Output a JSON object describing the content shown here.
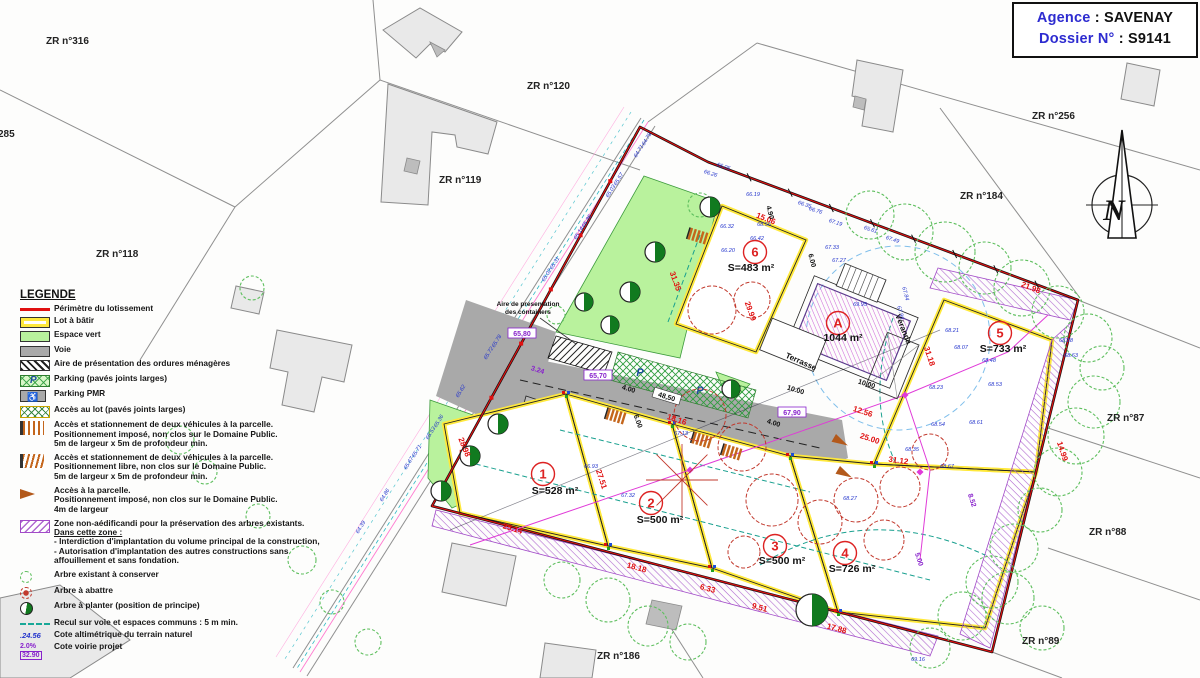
{
  "header": {
    "agency_label": "Agence",
    "agency_sep": " : ",
    "agency_value": "SAVENAY",
    "dossier_label": "Dossier N°",
    "dossier_sep": " : ",
    "dossier_value": "S9141"
  },
  "colors": {
    "perimeter_red": "#e01010",
    "lot_yellow": "#ffe93c",
    "green_space": "#b9f29d",
    "road_gray": "#a9a9a9",
    "hatch_purple": "#a24bc8",
    "elevation_blue": "#2233cc",
    "label_blue": "#2d2bd0",
    "tree_green": "#5fbf5f",
    "tree_red": "#c23a2e",
    "tree_plant_green": "#117a1f",
    "setback_teal": "#18a898"
  },
  "north": {
    "label": "N"
  },
  "legend": {
    "title": "LEGENDE",
    "items": [
      {
        "swatch": "perimeter",
        "lines": [
          "Périmètre du lotissement"
        ]
      },
      {
        "swatch": "lot",
        "lines": [
          "Lot à bâtir"
        ]
      },
      {
        "swatch": "green",
        "lines": [
          "Espace vert"
        ]
      },
      {
        "swatch": "road",
        "lines": [
          "Voie"
        ]
      },
      {
        "swatch": "waste",
        "lines": [
          "Aire de présentation des ordures ménagères"
        ]
      },
      {
        "swatch": "parking",
        "lines": [
          "Parking (pavés joints larges)"
        ]
      },
      {
        "swatch": "pmr",
        "lines": [
          "Parking PMR"
        ]
      },
      {
        "swatch": "access-lot",
        "lines": [
          "Accès au lot (pavés joints larges)"
        ]
      },
      {
        "swatch": "bars",
        "lines": [
          "Accès et stationnement de deux véhicules à la parcelle.",
          "Positionnement imposé, non clos sur le Domaine Public.",
          "5m de largeur x 5m de profondeur min."
        ]
      },
      {
        "swatch": "bars-m",
        "lines": [
          "Accès et stationnement de deux véhicules à la parcelle.",
          "Positionnement libre, non clos sur le Domaine Public.",
          "5m de largeur x 5m de profondeur min."
        ]
      },
      {
        "swatch": "arrow",
        "lines": [
          "Accès à la parcelle.",
          "Positionnement imposé, non clos sur le Domaine Public.",
          "4m de largeur"
        ]
      },
      {
        "swatch": "zone",
        "underline_index": 1,
        "lines": [
          "Zone non-aédificandi pour la préservation des arbres existants.",
          "Dans cette zone :",
          " - Interdiction d'implantation du volume principal de la construction,",
          " - Autorisation d'implantation des autres constructions sans",
          "affouillement et sans fondation."
        ]
      },
      {
        "swatch": "tree-keep",
        "lines": [
          "Arbre existant à conserver"
        ]
      },
      {
        "swatch": "tree-cut",
        "lines": [
          "Arbre à abattre"
        ]
      },
      {
        "swatch": "tree-plant",
        "lines": [
          "Arbre à planter (position de principe)"
        ]
      },
      {
        "swatch": "setback",
        "lines": [
          "Recul sur voie et espaces communs : 5 m min."
        ]
      },
      {
        "swatch": "cote-alt",
        "swatch_text": ".24.56",
        "lines": [
          "Cote altimétrique du terrain naturel"
        ]
      },
      {
        "swatch": "cote-road",
        "swatch_text2": "2.0%",
        "swatch_text": "32.90",
        "lines": [
          "Cote voirie projet"
        ]
      }
    ]
  },
  "parcels": [
    {
      "label": "ZR n°316",
      "x": 46,
      "y": 36
    },
    {
      "label": "285",
      "x": -2,
      "y": 129
    },
    {
      "label": "ZR n°120",
      "x": 527,
      "y": 81
    },
    {
      "label": "ZR n°119",
      "x": 439,
      "y": 175
    },
    {
      "label": "ZR n°118",
      "x": 96,
      "y": 249
    },
    {
      "label": "ZR n°256",
      "x": 1032,
      "y": 111
    },
    {
      "label": "ZR n°184",
      "x": 960,
      "y": 191
    },
    {
      "label": "ZR n°87",
      "x": 1107,
      "y": 413
    },
    {
      "label": "ZR n°88",
      "x": 1089,
      "y": 527
    },
    {
      "label": "ZR n°89",
      "x": 1022,
      "y": 636
    },
    {
      "label": "ZR n°186",
      "x": 597,
      "y": 651
    }
  ],
  "lots": [
    {
      "id": "1",
      "area": "S=528 m²",
      "cx": 543,
      "cy": 474,
      "ax": 555,
      "ay": 494
    },
    {
      "id": "2",
      "area": "S=500 m²",
      "cx": 651,
      "cy": 503,
      "ax": 660,
      "ay": 523
    },
    {
      "id": "3",
      "area": "S=500 m²",
      "cx": 775,
      "cy": 546,
      "ax": 782,
      "ay": 564
    },
    {
      "id": "4",
      "area": "S=726 m²",
      "cx": 845,
      "cy": 553,
      "ax": 852,
      "ay": 572
    },
    {
      "id": "5",
      "area": "S=733 m²",
      "cx": 1000,
      "cy": 333,
      "ax": 1003,
      "ay": 352
    },
    {
      "id": "6",
      "area": "S=483 m²",
      "cx": 755,
      "cy": 252,
      "ax": 751,
      "ay": 271
    },
    {
      "id": "A",
      "area": "1044 m²",
      "cx": 838,
      "cy": 323,
      "ax": 843,
      "ay": 341
    }
  ],
  "plan_labels": [
    {
      "text": "Terrasse",
      "x": 800,
      "y": 364,
      "r": 24,
      "size": 8
    },
    {
      "text": "Véranda",
      "x": 901,
      "y": 330,
      "r": 68,
      "size": 8
    },
    {
      "text": "Aire de présentation",
      "x": 528,
      "y": 306,
      "r": 0,
      "size": 6.5
    },
    {
      "text": "des containers",
      "x": 528,
      "y": 314,
      "r": 0,
      "size": 6.5
    }
  ],
  "boxed_cotes": [
    {
      "v": "65,80",
      "x": 522,
      "y": 335
    },
    {
      "v": "65,70",
      "x": 598,
      "y": 377
    },
    {
      "v": "67,90",
      "x": 792,
      "y": 414
    }
  ],
  "dims_red": [
    {
      "v": "15.06",
      "x": 765,
      "y": 221,
      "r": 21
    },
    {
      "v": "29.99",
      "x": 748,
      "y": 312,
      "r": 70
    },
    {
      "v": "31.35",
      "x": 673,
      "y": 282,
      "r": 70
    },
    {
      "v": "27.51",
      "x": 599,
      "y": 480,
      "r": 72
    },
    {
      "v": "28.98",
      "x": 462,
      "y": 448,
      "r": 68
    },
    {
      "v": "25.14",
      "x": 512,
      "y": 531,
      "r": 17
    },
    {
      "v": "18.18",
      "x": 636,
      "y": 570,
      "r": 15
    },
    {
      "v": "6.33",
      "x": 707,
      "y": 591,
      "r": 15
    },
    {
      "v": "9.51",
      "x": 759,
      "y": 610,
      "r": 15
    },
    {
      "v": "17.88",
      "x": 836,
      "y": 631,
      "r": 15
    },
    {
      "v": "31.18",
      "x": 927,
      "y": 357,
      "r": 72
    },
    {
      "v": "31.12",
      "x": 898,
      "y": 463,
      "r": 8
    },
    {
      "v": "25.00",
      "x": 869,
      "y": 441,
      "r": 18
    },
    {
      "v": "14.99",
      "x": 1060,
      "y": 452,
      "r": 72
    },
    {
      "v": "21.98",
      "x": 1030,
      "y": 290,
      "r": 21
    },
    {
      "v": "12.56",
      "x": 862,
      "y": 414,
      "r": 18
    },
    {
      "v": "18.16",
      "x": 676,
      "y": 422,
      "r": 18
    }
  ],
  "dims_black": [
    {
      "v": "48,50",
      "x": 666,
      "y": 399,
      "r": 17,
      "box": 1
    },
    {
      "v": "10.00",
      "x": 795,
      "y": 392,
      "r": 17
    },
    {
      "v": "10,00",
      "x": 866,
      "y": 386,
      "r": 17
    },
    {
      "v": "4.00",
      "x": 628,
      "y": 391,
      "r": 17
    },
    {
      "v": "4.00",
      "x": 773,
      "y": 425,
      "r": 17
    },
    {
      "v": "6.00",
      "x": 636,
      "y": 422,
      "r": 70
    },
    {
      "v": "6.00",
      "x": 810,
      "y": 261,
      "r": 75
    },
    {
      "v": "4.90",
      "x": 768,
      "y": 213,
      "r": 75
    }
  ],
  "dims_purple": [
    {
      "v": "8.52",
      "x": 970,
      "y": 501,
      "r": 72
    },
    {
      "v": "5.00",
      "x": 917,
      "y": 560,
      "r": 72
    },
    {
      "v": "3.24",
      "x": 537,
      "y": 372,
      "r": 17
    }
  ],
  "elevations": [
    [
      753,
      196,
      "66.19",
      0
    ],
    [
      727,
      228,
      "66.32",
      0
    ],
    [
      764,
      226,
      "68.56",
      0
    ],
    [
      757,
      240,
      "66.42",
      0
    ],
    [
      728,
      252,
      "66.20",
      0
    ],
    [
      723,
      168,
      "66.05",
      18
    ],
    [
      710,
      175,
      "66.26",
      18
    ],
    [
      804,
      206,
      "66.35",
      18
    ],
    [
      815,
      212,
      "66.76",
      18
    ],
    [
      835,
      224,
      "67.19",
      18
    ],
    [
      832,
      249,
      "67.33",
      0
    ],
    [
      839,
      262,
      "67.27",
      0
    ],
    [
      870,
      231,
      "65.61",
      18
    ],
    [
      892,
      241,
      "67.49",
      18
    ],
    [
      904,
      294,
      "67.84",
      75
    ],
    [
      899,
      313,
      "67.96",
      75
    ],
    [
      952,
      332,
      "68.21",
      0
    ],
    [
      961,
      349,
      "68.07",
      0
    ],
    [
      989,
      362,
      "68.48",
      0
    ],
    [
      995,
      386,
      "68.53",
      0
    ],
    [
      936,
      389,
      "68.23",
      0
    ],
    [
      938,
      426,
      "68.54",
      0
    ],
    [
      976,
      424,
      "68.61",
      0
    ],
    [
      1066,
      342,
      "68.88",
      0
    ],
    [
      1071,
      357,
      "68.63",
      0
    ],
    [
      850,
      500,
      "68.27",
      0
    ],
    [
      912,
      451,
      "68.35",
      0
    ],
    [
      947,
      468,
      "68.67",
      0
    ],
    [
      591,
      468,
      "66.93",
      0
    ],
    [
      628,
      497,
      "67.32",
      0
    ],
    [
      681,
      435,
      "67.13",
      0
    ],
    [
      918,
      661,
      "69.16",
      0
    ],
    [
      860,
      306,
      "69.95",
      0
    ],
    [
      648,
      140,
      "64.78",
      -58
    ],
    [
      640,
      152,
      "64.71",
      -58
    ],
    [
      620,
      180,
      "65.57",
      -58
    ],
    [
      612,
      192,
      "65.03",
      -58
    ],
    [
      588,
      222,
      "65.36",
      -58
    ],
    [
      580,
      234,
      "65.14",
      -58
    ],
    [
      556,
      264,
      "65.31",
      -58
    ],
    [
      548,
      276,
      "65.02",
      -58
    ],
    [
      498,
      342,
      "65.78",
      -58
    ],
    [
      490,
      354,
      "65.72",
      -58
    ],
    [
      462,
      392,
      "65.62",
      -58
    ],
    [
      440,
      422,
      "65.36",
      -58
    ],
    [
      432,
      434,
      "65.53",
      -58
    ],
    [
      418,
      452,
      "65.71",
      -58
    ],
    [
      410,
      464,
      "65.67",
      -58
    ],
    [
      386,
      496,
      "64.86",
      -58
    ],
    [
      362,
      528,
      "64.39",
      -58
    ]
  ]
}
